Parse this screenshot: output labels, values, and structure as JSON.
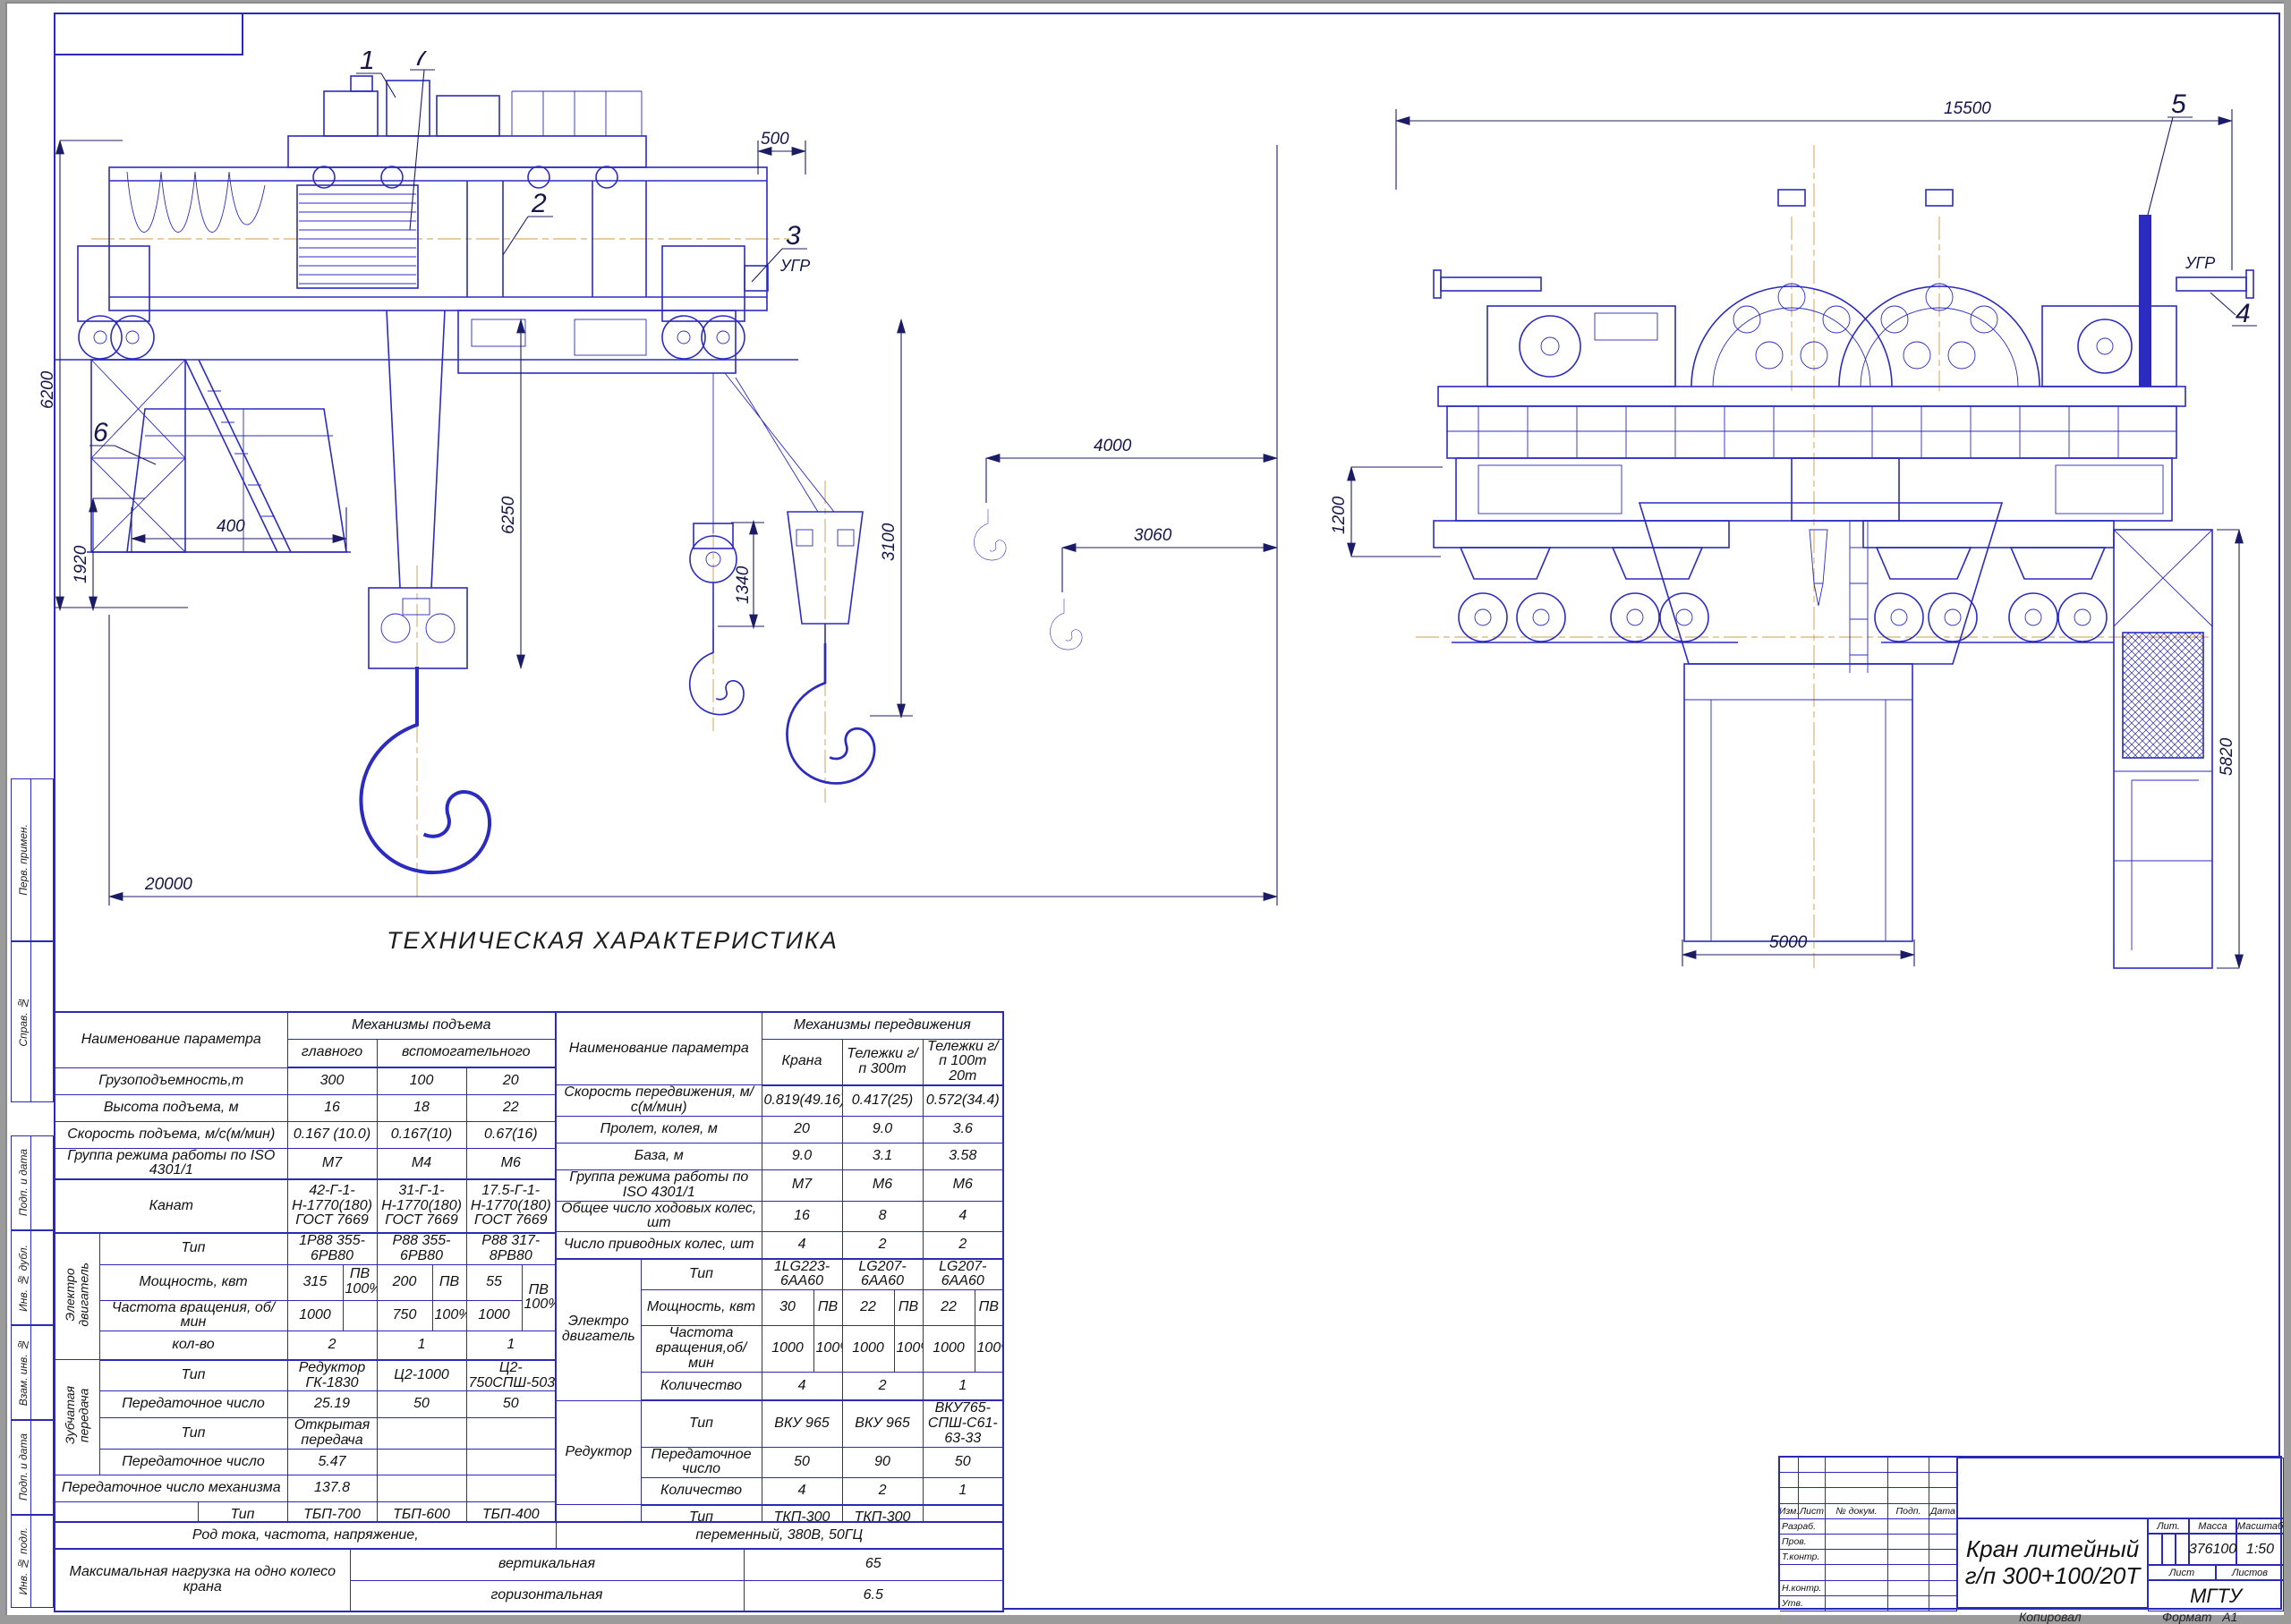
{
  "margin_labels": [
    "Перв. примен.",
    "Справ. №",
    "Подп. и дата",
    "Инв. № дубл.",
    "Взам. инв. №",
    "Подп. и дата",
    "Инв. № подл."
  ],
  "drawing": {
    "ugr": "УГР",
    "callouts": [
      "1",
      "2",
      "3",
      "4",
      "5",
      "6",
      "7"
    ],
    "side_dims": {
      "total_height": "6200",
      "rail_height": "1920",
      "end_offset": "500",
      "aux_block": "1340",
      "main_hook": "6250",
      "aux_hook": "3100",
      "hook_gap1": "4000",
      "hook_gap2": "3060",
      "span": "20000",
      "cab": "400"
    },
    "end_dims": {
      "overall": "15500",
      "buffer": "1200",
      "cage": "5820",
      "ladle": "5000"
    }
  },
  "spec_table": {
    "heading": "ТЕХНИЧЕСКАЯ ХАРАКТЕРИСТИКА",
    "left": {
      "param_header": "Наименование параметра",
      "group_header": "Механизмы подъема",
      "sub_main": "главного",
      "sub_aux": "вспомогательного",
      "capacity": {
        "label": "Грузоподъемность,т",
        "v": [
          "300",
          "100",
          "20"
        ]
      },
      "lift_height": {
        "label": "Высота подъема, м",
        "v": [
          "16",
          "18",
          "22"
        ]
      },
      "lift_speed": {
        "label": "Скорость подъема, м/с(м/мин)",
        "v": [
          "0.167 (10.0)",
          "0.167(10)",
          "0.67(16)"
        ]
      },
      "duty": {
        "label": "Группа режима работы по ISO 4301/1",
        "v": [
          "М7",
          "М4",
          "М6"
        ]
      },
      "rope": {
        "label": "Канат",
        "v": [
          "42-Г-1-Н-1770(180)\nГОСТ 7669",
          "31-Г-1-Н-1770(180)\nГОСТ 7669",
          "17.5-Г-1-Н-1770(180)\nГОСТ 7669"
        ]
      },
      "motor_group": "Электро\nдвигатель",
      "motor_type": {
        "label": "Тип",
        "v": [
          "1Р88 355-6РВ80",
          "Р88 355-6РВ80",
          "Р88 317-8РВ80"
        ]
      },
      "motor_power": {
        "label": "Мощность, квт",
        "v": [
          "315",
          "200",
          "55"
        ],
        "pv": [
          "ПВ\n100%",
          "ПВ",
          "ПВ\n100%"
        ]
      },
      "motor_freq": {
        "label": "Частота вращения, об/мин",
        "v": [
          "1000",
          "750",
          "1000"
        ],
        "pv": [
          "",
          "100%",
          ""
        ]
      },
      "motor_qty": {
        "label": "кол-во",
        "v": [
          "2",
          "1",
          "1"
        ]
      },
      "gear_group": "Зубчатая\nпередача",
      "gear_type": {
        "label": "Тип",
        "v": [
          "Редуктор ГК-1830",
          "Ц2-1000",
          "Ц2-750СПШ-5031"
        ]
      },
      "gear_ratio": {
        "label": "Передаточное число",
        "v": [
          "25.19",
          "50",
          "50"
        ]
      },
      "gear_type2": {
        "label": "Тип",
        "v": [
          "Открытая передача",
          "",
          ""
        ]
      },
      "gear_ratio2": {
        "label": "Передаточное число",
        "v": [
          "5.47",
          "",
          ""
        ]
      },
      "mech_ratio": {
        "label": "Передаточное число механизма",
        "v": [
          "137.8",
          "",
          ""
        ]
      },
      "brake_group": "Тормоз",
      "brake_type": {
        "label": "Тип",
        "v": [
          "ТБП-700",
          "ТБП-600",
          "ТБП-400"
        ]
      },
      "brake_qty": {
        "label": "Количество",
        "v": [
          "4",
          "2",
          "1"
        ]
      }
    },
    "right": {
      "param_header": "Наименование параметра",
      "group_header": "Механизмы передвижения",
      "col_crane": "Крана",
      "col_tr300": "Тележки г/п 300т",
      "col_tr100": "Тележки г/п 100т\n20т",
      "travel_speed": {
        "label": "Скорость передвижения, м/с(м/мин)",
        "v": [
          "0.819(49.16)",
          "0.417(25)",
          "0.572(34.4)"
        ]
      },
      "span": {
        "label": "Пролет, колея, м",
        "v": [
          "20",
          "9.0",
          "3.6"
        ]
      },
      "base": {
        "label": "База, м",
        "v": [
          "9.0",
          "3.1",
          "3.58"
        ]
      },
      "duty": {
        "label": "Группа режима работы по ISO 4301/1",
        "v": [
          "М7",
          "М6",
          "М6"
        ]
      },
      "wheels_total": {
        "label": "Общее число ходовых колес, шт",
        "v": [
          "16",
          "8",
          "4"
        ]
      },
      "wheels_driven": {
        "label": "Число приводных колес, шт",
        "v": [
          "4",
          "2",
          "2"
        ]
      },
      "motor_group": "Электро\nдвигатель",
      "motor_type": {
        "label": "Тип",
        "v": [
          "1LG223-6АА60",
          "LG207-6АА60",
          "LG207-6АА60"
        ]
      },
      "motor_power": {
        "label": "Мощность, квт",
        "v": [
          "30",
          "22",
          "22"
        ],
        "pv": [
          "ПВ",
          "ПВ",
          "ПВ"
        ]
      },
      "motor_freq": {
        "label": "Частота вращения,об/мин",
        "v": [
          "1000",
          "1000",
          "1000"
        ],
        "pv": [
          "100%",
          "100%",
          "100%"
        ]
      },
      "motor_qty": {
        "label": "Количество",
        "v": [
          "4",
          "2",
          "1"
        ]
      },
      "reducer_group": "Редуктор",
      "reducer_type": {
        "label": "Тип",
        "v": [
          "ВКУ 965",
          "ВКУ 965",
          "ВКУ765-СПШ-С61-63-33"
        ]
      },
      "reducer_ratio": {
        "label": "Передаточное число",
        "v": [
          "50",
          "90",
          "50"
        ]
      },
      "reducer_qty": {
        "label": "Количество",
        "v": [
          "4",
          "2",
          "1"
        ]
      },
      "brake_group": "Тормоз",
      "brake_type": {
        "label": "Тип",
        "v": [
          "ТКП-300",
          "ТКП-300",
          ""
        ]
      },
      "brake_qty": {
        "label": "Количество",
        "v": [
          "4",
          "2",
          "120"
        ]
      },
      "rail_group": "Тип рельса\nГОСТ 4121",
      "rail_crane": {
        "label": "Подкранового",
        "v": [
          "КР 140",
          "",
          ""
        ]
      },
      "rail_trolley": {
        "label": "Подтележечного",
        "v": [
          "",
          "КР120",
          "КР120"
        ]
      }
    },
    "bottom": {
      "current_label": "Род тока, частота, напряжение,",
      "current_value": "переменный, 380В, 50ГЦ",
      "load_label": "Максимальная нагрузка на одно колесо крана",
      "vert_label": "вертикальная",
      "vert_value": "65",
      "horiz_label": "горизонтальная",
      "horiz_value": "6.5"
    }
  },
  "title_block": {
    "cols": [
      "Изм.",
      "Лист",
      "№ докум.",
      "Подп.",
      "Дата"
    ],
    "roles": [
      "Разраб.",
      "Пров.",
      "Т.контр.",
      "",
      "Н.контр.",
      "Утв."
    ],
    "title1": "Кран литейный",
    "title2": "г/п 300+100/20Т",
    "lit": "Лит.",
    "mass_label": "Масса",
    "mass": "376100",
    "scale_label": "Масштаб",
    "scale": "1:50",
    "sheet": "Лист",
    "sheets": "Листов",
    "org": "МГТУ"
  },
  "footer": {
    "copied": "Копировал",
    "format_label": "Формат",
    "format_value": "А1"
  }
}
